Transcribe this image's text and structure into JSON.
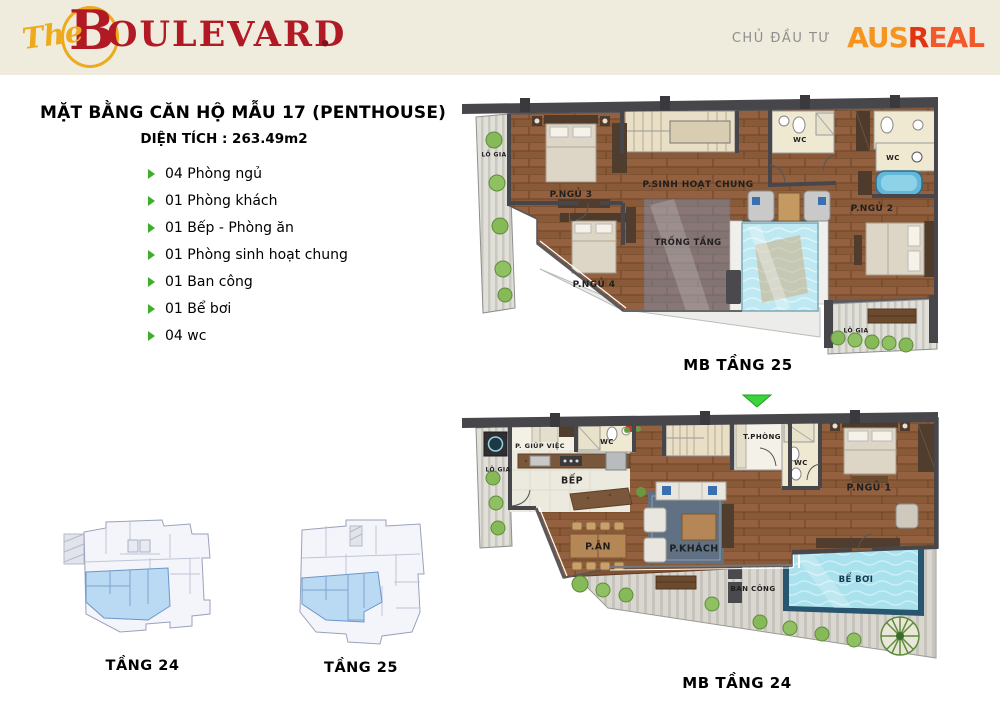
{
  "header": {
    "brand": {
      "prefix": "The",
      "initial": "B",
      "rest": "OULEVARD",
      "suffix": "."
    },
    "developer": {
      "label": "CHỦ ĐẦU TƯ",
      "part_aus": "AUS",
      "part_r": "R",
      "part_eal": "EAL"
    }
  },
  "info": {
    "title": "MẶT BẰNG CĂN HỘ MẪU 17 (PENTHOUSE)",
    "area_label": "DIỆN TÍCH : 263.49m2",
    "features": [
      "04 Phòng ngủ",
      "01 Phòng khách",
      "01 Bếp - Phòng ăn",
      "01 Phòng sinh hoạt chung",
      "01 Ban công",
      "01 Bể bơi",
      "04 wc"
    ]
  },
  "plan25": {
    "caption": "MB TẦNG 25",
    "rooms": {
      "lo_gia": "LÔ GIA",
      "p_ngu_3": "P.NGỦ 3",
      "p_ngu_4": "P.NGỦ 4",
      "p_sinh_hoat_chung": "P.SINH HOẠT CHUNG",
      "trong_tang": "TRỐNG TẦNG",
      "wc_1": "WC",
      "wc_2": "WC",
      "p_ngu_2": "P.NGỦ 2",
      "lo_gia_2": "LÔ GIA"
    }
  },
  "plan24": {
    "caption": "MB TẦNG 24",
    "rooms": {
      "lo_gia": "LÔ GIA",
      "p_giup_viec": "P. GIÚP VIỆC",
      "wc_1": "WC",
      "bep": "BẾP",
      "t_phong": "T.PHÒNG",
      "wc_2": "WC",
      "p_ngu_1": "P.NGỦ 1",
      "p_an": "P.ĂN",
      "p_khach": "P.KHÁCH",
      "ban_cong": "BAN CÔNG",
      "be_boi": "BỂ BƠI"
    }
  },
  "mini_plans": [
    {
      "caption": "TẦNG 24"
    },
    {
      "caption": "TẦNG 25"
    }
  ],
  "colors": {
    "header_cream": "#efebdd",
    "brand_red": "#b11a24",
    "brand_gold": "#edaa1b",
    "ausreal_orange": "#f7941d",
    "ausreal_red": "#e23312",
    "bullet_green": "#3fae2a",
    "arrow_green": "#39d439",
    "highlight_blue": "#badaf4",
    "pool_blue": "#a9e1ed"
  }
}
